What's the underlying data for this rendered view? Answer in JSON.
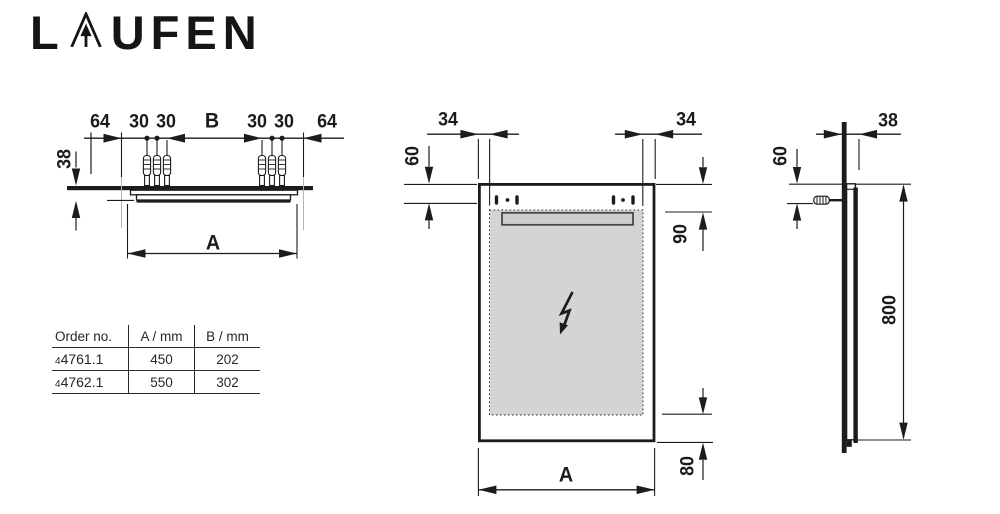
{
  "colors": {
    "ink": "#1c1c1e",
    "gray_fill": "#d4d4d4",
    "bar_fill": "#cdcdcd",
    "table_line": "#2a2a2a",
    "faint": "#b5b5b5"
  },
  "logo": {
    "part1": "L",
    "part2": "UFEN",
    "arrow_a_icon": "laufen-arrow-a"
  },
  "top_view": {
    "dim_64_left": "64",
    "dim_30_left_outer": "30",
    "dim_30_left_inner": "30",
    "dim_b": "B",
    "dim_30_right_inner": "30",
    "dim_30_right_outer": "30",
    "dim_64_right": "64",
    "dim_38_depth": "38",
    "dim_a_width": "A"
  },
  "front_view": {
    "dim_34_left": "34",
    "dim_34_right": "34",
    "dim_60_top": "60",
    "dim_90_light": "90",
    "dim_80_bottom": "80",
    "dim_a_width": "A"
  },
  "side_view": {
    "dim_38_depth": "38",
    "dim_60_top": "60",
    "dim_800_height": "800"
  },
  "table": {
    "headers": [
      "Order no.",
      "A / mm",
      "B / mm"
    ],
    "rows": [
      {
        "order_prefix": "4",
        "order_no": "4761.1",
        "a_mm": "450",
        "b_mm": "202"
      },
      {
        "order_prefix": "4",
        "order_no": "4762.1",
        "a_mm": "550",
        "b_mm": "302"
      }
    ]
  }
}
